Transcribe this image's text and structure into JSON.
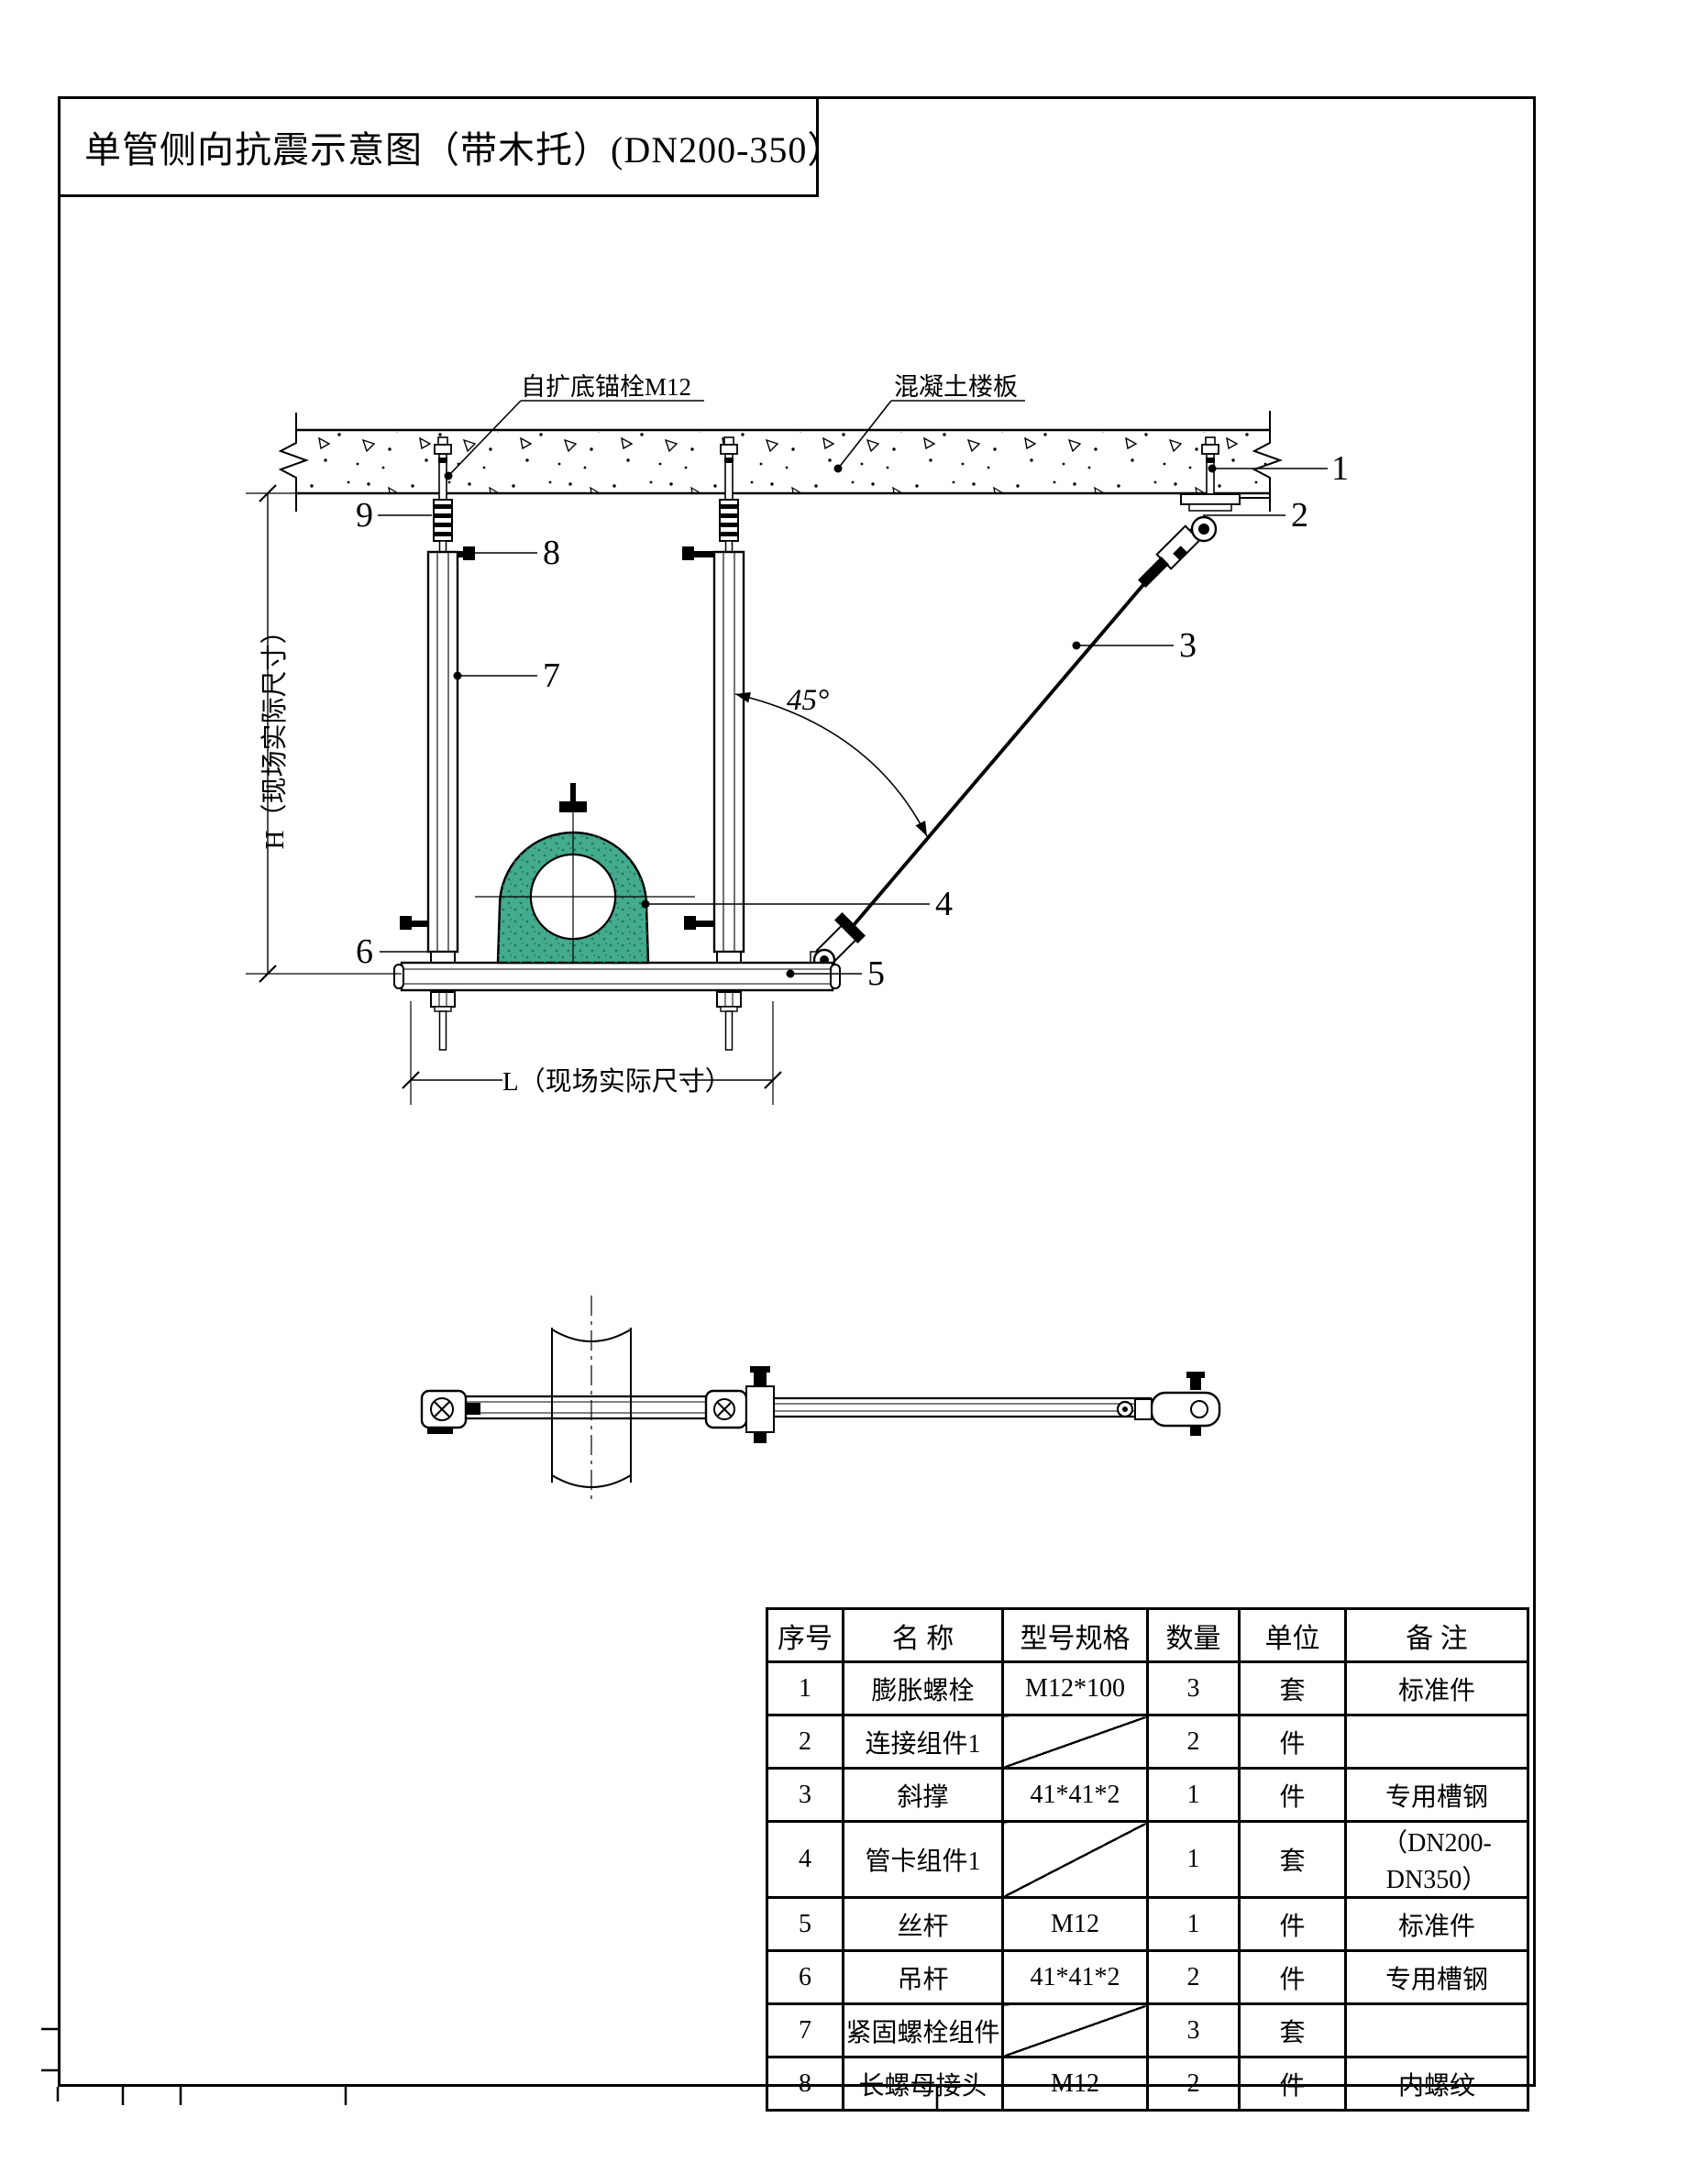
{
  "title": "单管侧向抗震示意图（带木托）(DN200-350）",
  "labels": {
    "anchor_bolt": "自扩底锚栓M12",
    "concrete_slab": "混凝土楼板",
    "angle": "45°",
    "dim_h": "H（现场实际尺寸）",
    "dim_l": "L（现场实际尺寸）"
  },
  "callouts": {
    "c1": "1",
    "c2": "2",
    "c3": "3",
    "c4": "4",
    "c5": "5",
    "c6": "6",
    "c7": "7",
    "c8": "8",
    "c9": "9"
  },
  "colors": {
    "clamp_green": "#45AB8E",
    "clamp_speckle": "#1E7A5F",
    "line": "#000000"
  },
  "table": {
    "headers": [
      "序号",
      "名 称",
      "型号规格",
      "数量",
      "单位",
      "备 注"
    ],
    "rows": [
      [
        "1",
        "膨胀螺栓",
        "M12*100",
        "3",
        "套",
        "标准件"
      ],
      [
        "2",
        "连接组件1",
        "",
        "2",
        "件",
        ""
      ],
      [
        "3",
        "斜撑",
        "41*41*2",
        "1",
        "件",
        "专用槽钢"
      ],
      [
        "4",
        "管卡组件1",
        "",
        "1",
        "套",
        "（DN200-DN350）"
      ],
      [
        "5",
        "丝杆",
        "M12",
        "1",
        "件",
        "标准件"
      ],
      [
        "6",
        "吊杆",
        "41*41*2",
        "2",
        "件",
        "专用槽钢"
      ],
      [
        "7",
        "紧固螺栓组件",
        "",
        "3",
        "套",
        ""
      ],
      [
        "8",
        "长螺母接头",
        "M12",
        "2",
        "件",
        "内螺纹"
      ]
    ]
  }
}
